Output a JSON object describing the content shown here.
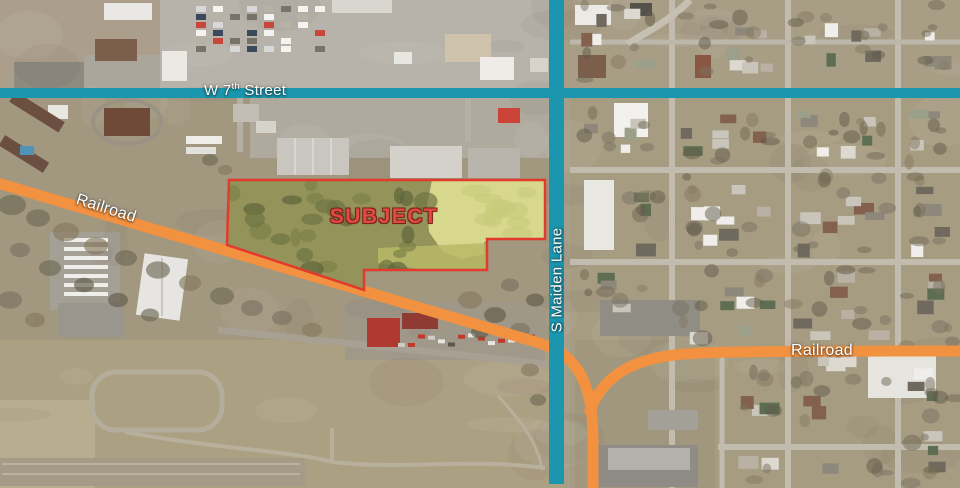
{
  "overlay": {
    "streets": {
      "w7th": {
        "label_prefix": "W 7",
        "label_sup": "th",
        "label_suffix": " Street"
      },
      "maiden": {
        "label": "S Maiden Lane"
      }
    },
    "railroads": {
      "west": {
        "label": "Railroad"
      },
      "east": {
        "label": "Railroad"
      }
    },
    "subject": {
      "label": "SUBJECT"
    }
  },
  "colors": {
    "street_line": "#1B96AE",
    "railroad_line": "#F2913F",
    "subject_outline": "#E23B2D",
    "subject_fill_dark": "#93935A",
    "subject_fill_light": "#D7D88D",
    "subject_text": "#DF4A41",
    "label_text": "#FFFFFF"
  }
}
